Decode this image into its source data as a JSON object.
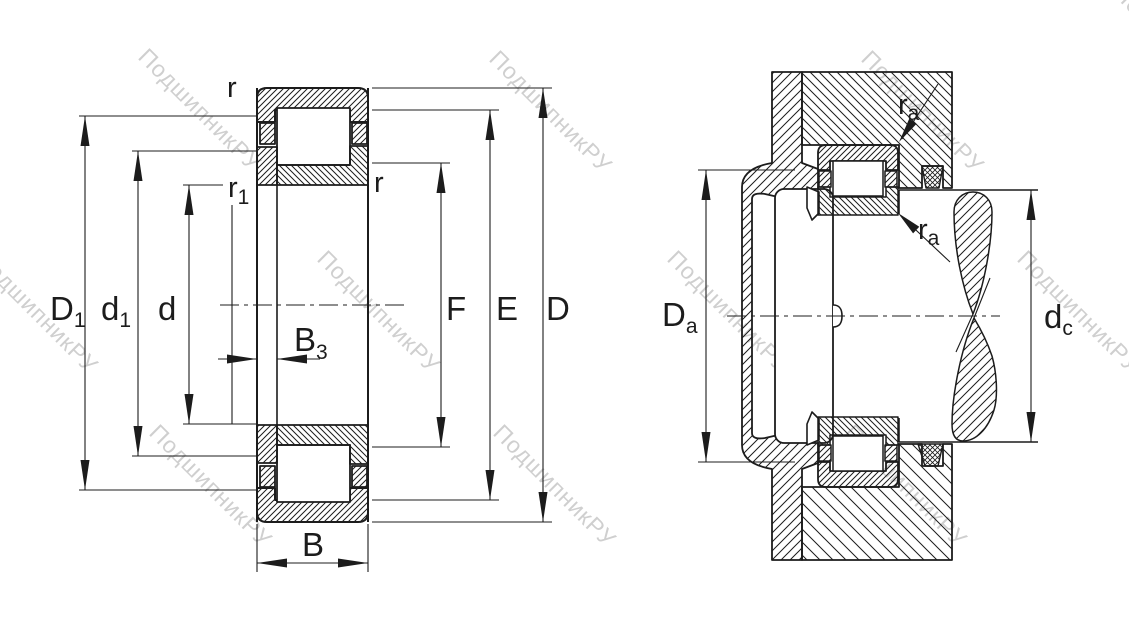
{
  "figure": {
    "kind": "bearing-technical-drawing",
    "watermark": {
      "text": "ПодшипникРУ",
      "color": "#c7c7c7"
    },
    "colors": {
      "line": "#1c1c1c",
      "background": "#ffffff"
    }
  },
  "left_view": {
    "labels": {
      "D1": {
        "main": "D",
        "sub": "1"
      },
      "d1": {
        "main": "d",
        "sub": "1"
      },
      "d": {
        "main": "d"
      },
      "B3": {
        "main": "B",
        "sub": "3"
      },
      "B": {
        "main": "B"
      },
      "F": {
        "main": "F"
      },
      "E": {
        "main": "E"
      },
      "D": {
        "main": "D"
      },
      "r_top": {
        "main": "r"
      },
      "r1": {
        "main": "r",
        "sub": "1"
      },
      "r_inner": {
        "main": "r"
      }
    }
  },
  "right_view": {
    "labels": {
      "Da": {
        "main": "D",
        "sub": "a"
      },
      "dc": {
        "main": "d",
        "sub": "c"
      },
      "ra_top": {
        "main": "r",
        "sub": "a"
      },
      "ra_bottom": {
        "main": "r",
        "sub": "a"
      }
    }
  }
}
